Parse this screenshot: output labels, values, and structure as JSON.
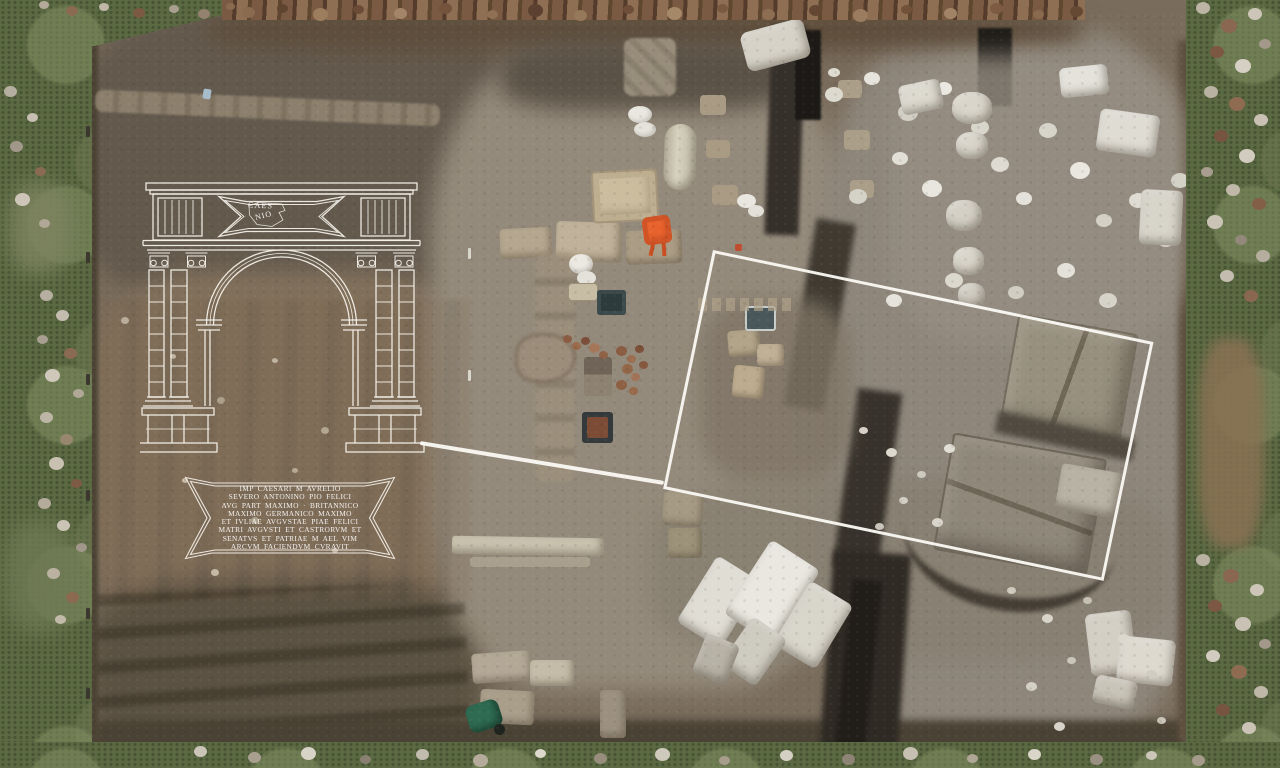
{
  "scene": {
    "subject": "aerial-view-roman-arch-excavation",
    "palette": {
      "overlay_white": "#f7f4ed",
      "grass_green": "#5c6a43",
      "soil_brown": "#796c5c",
      "soil_reddish": "#81705b",
      "marble_white": "#dedbd2",
      "trench_dark": "#2e2a24",
      "wheelbarrow_orange": "#e8622d",
      "wheelbarrow_green": "#2e6b52"
    }
  },
  "overlay": {
    "arch_fragment": {
      "line1": "CAES",
      "line2": "NIO"
    },
    "plaque": {
      "lines": [
        "IMP CAESARI M AVRELIO",
        "SEVERO ANTONINO PIO FELICI",
        "AVG PART MAXIMO · BRITANNICO",
        "MAXIMO GERMANICO MAXIMO",
        "ET IVLIAE AVGVSTAE PIAE FELICI",
        "MATRI AVGVSTI ET CASTRORVM ET",
        "SENATVS ET PATRIAE M AEL VIM",
        "ARCVM FACIENDVM CVRAVIT"
      ]
    }
  }
}
